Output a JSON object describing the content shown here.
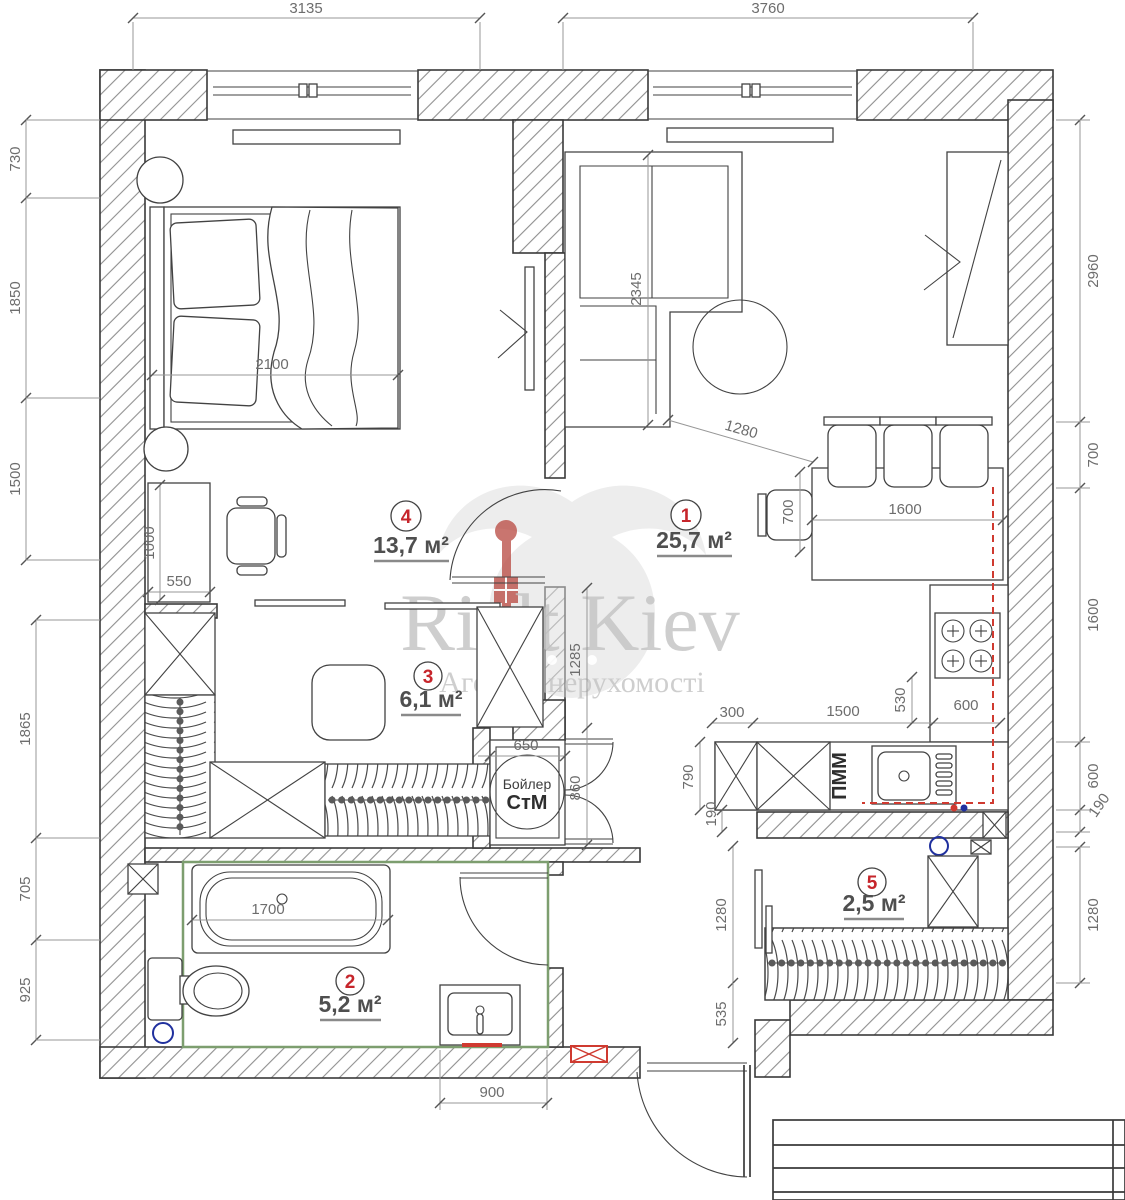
{
  "watermark": {
    "brand_first": "Rielt",
    "brand_second": "Kiev",
    "tagline": "Агенція нерухомості"
  },
  "rooms": [
    {
      "number": "1",
      "area": "25,7 м²"
    },
    {
      "number": "2",
      "area": "5,2 м²"
    },
    {
      "number": "3",
      "area": "6,1 м²"
    },
    {
      "number": "4",
      "area": "13,7 м²"
    },
    {
      "number": "5",
      "area": "2,5 м²"
    }
  ],
  "equipment": {
    "boiler": "Бойлер",
    "washing_machine": "СтМ",
    "dishwasher": "ПММ"
  },
  "colors": {
    "room_number": "#c6252b",
    "plumbing_line": "#cf3a30",
    "water_point": "#20309e",
    "wet_zone_outline": "#7d9e6f"
  },
  "dimensions": {
    "top": [
      "3135",
      "3760"
    ],
    "left": [
      "730",
      "1850",
      "1500",
      "1865",
      "705",
      "925"
    ],
    "right": [
      "2960",
      "700",
      "1600",
      "600",
      "190",
      "1280"
    ],
    "bedroom": {
      "bed": "2100",
      "desk_width": "550",
      "desk_length": "1000"
    },
    "living": {
      "sofa": "2345",
      "passage": "1280",
      "table_width": "700",
      "table_length": "1600"
    },
    "hall": {
      "corridor": "1285",
      "niche_door": "860",
      "niche_width": "650"
    },
    "kitchen": {
      "corner": "300",
      "run": "1500",
      "stove_gap": "530",
      "stove_width": "600",
      "depth": "790",
      "gap": "190"
    },
    "storage": {
      "height": "1280",
      "offset": "535"
    },
    "bath": {
      "tub": "1700",
      "vanity": "900"
    }
  }
}
